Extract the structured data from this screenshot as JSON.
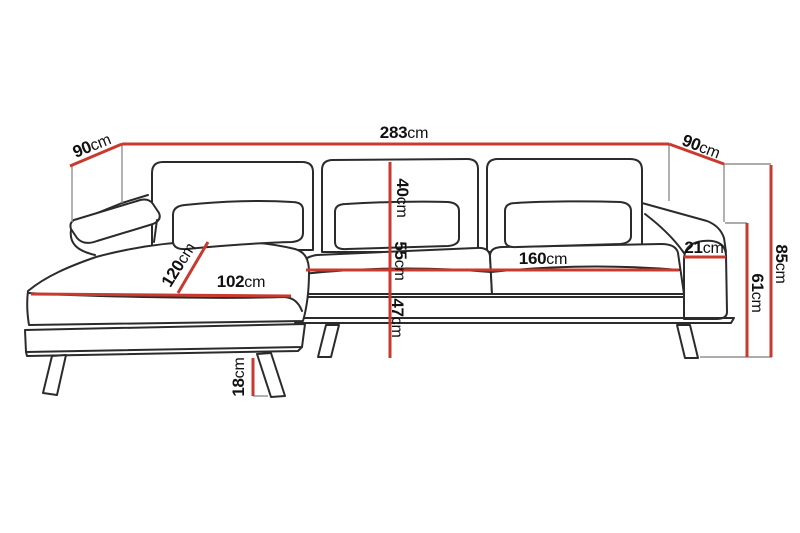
{
  "figure": {
    "type": "sofa-dimension-diagram",
    "description": "Line drawing of an L-shaped chaise sofa annotated with red dimension lines"
  },
  "colors": {
    "dimension_line": "#c9392e",
    "outline": "#2b2b2b",
    "leader": "#909090",
    "background": "#ffffff",
    "label_text": "#111111"
  },
  "dimensions": {
    "overall_width": {
      "value": "283",
      "unit": "cm"
    },
    "left_side_depth": {
      "value": "90",
      "unit": "cm"
    },
    "right_side_depth": {
      "value": "90",
      "unit": "cm"
    },
    "overall_height": {
      "value": "85",
      "unit": "cm"
    },
    "armrest_height": {
      "value": "61",
      "unit": "cm"
    },
    "armrest_width": {
      "value": "21",
      "unit": "cm"
    },
    "seat_width": {
      "value": "160",
      "unit": "cm"
    },
    "back_cushion_height": {
      "value": "40",
      "unit": "cm"
    },
    "seat_depth": {
      "value": "55",
      "unit": "cm"
    },
    "seat_height": {
      "value": "47",
      "unit": "cm"
    },
    "chaise_depth": {
      "value": "120",
      "unit": "cm"
    },
    "chaise_width": {
      "value": "102",
      "unit": "cm"
    },
    "leg_height": {
      "value": "18",
      "unit": "cm"
    }
  }
}
